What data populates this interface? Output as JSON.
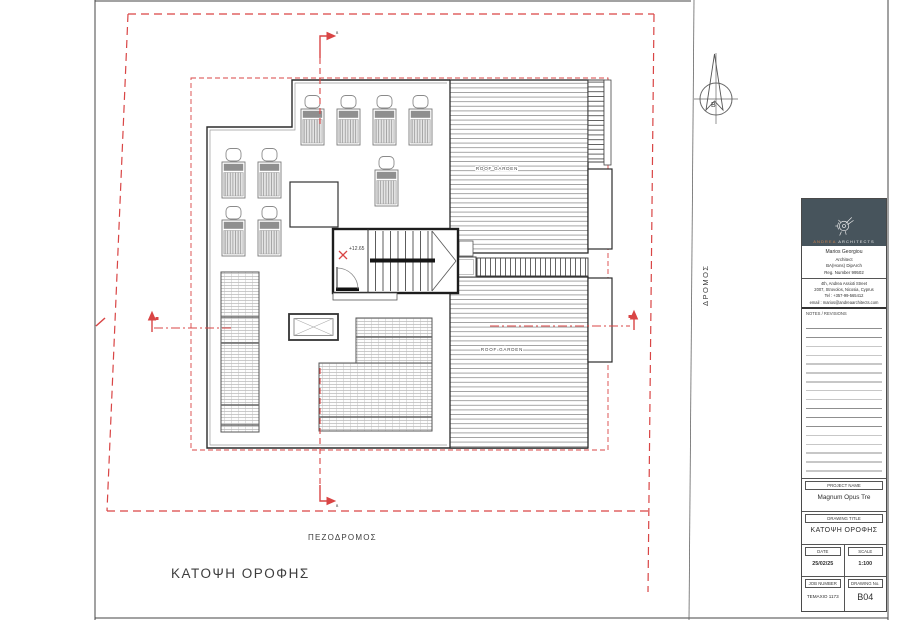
{
  "drawing": {
    "plan_title": "ΚΑΤΟΨΗ  ΟΡΟΦΗΣ",
    "street_label": "ΠΕΖΟΔΡΟΜΟΣ",
    "road_label": "ΔΡΟΜΟΣ",
    "north_letter": "B",
    "roof_garden_label": "ROOF GARDEN",
    "level_marker": "+12.65",
    "section_vertical_letter": "B",
    "section_horizontal_letter": "A"
  },
  "titleblock": {
    "brand_primary": "ANDREA",
    "brand_secondary": "ARCHITECTS",
    "architect_lines": [
      "Marios Georgiou",
      "Architect",
      "BA(Hons) DipArch",
      "Reg. Number 99502"
    ],
    "contact_lines": [
      "4th, Andrea Assioti Street",
      "2007, Strovolos, Nicosia, Cyprus",
      "Tel : +357-99-565412",
      "email : marios@andreaarchitects.com"
    ],
    "notes_label": "NOTES / REVISIONS",
    "project": {
      "label": "PROJECT NAME",
      "value": "Magnum Opus Tre"
    },
    "drawing_title": {
      "label": "DRAWING TITLE",
      "value": "ΚΑΤΟΨΗ ΟΡΟΦΗΣ"
    },
    "date": {
      "label": "DATE",
      "value": "25/02/25"
    },
    "scale": {
      "label": "SCALE",
      "value": "1:100"
    },
    "job_number": {
      "label": "JOB NUMBER",
      "value": "ΤΕΜΑΧΙΟ 1173"
    },
    "drawing_no": {
      "label": "DRAWING No.",
      "value": "B04"
    }
  },
  "colors": {
    "accent_red": "#d94545",
    "logo_background": "#47545c",
    "logo_orange": "#c9824f"
  }
}
